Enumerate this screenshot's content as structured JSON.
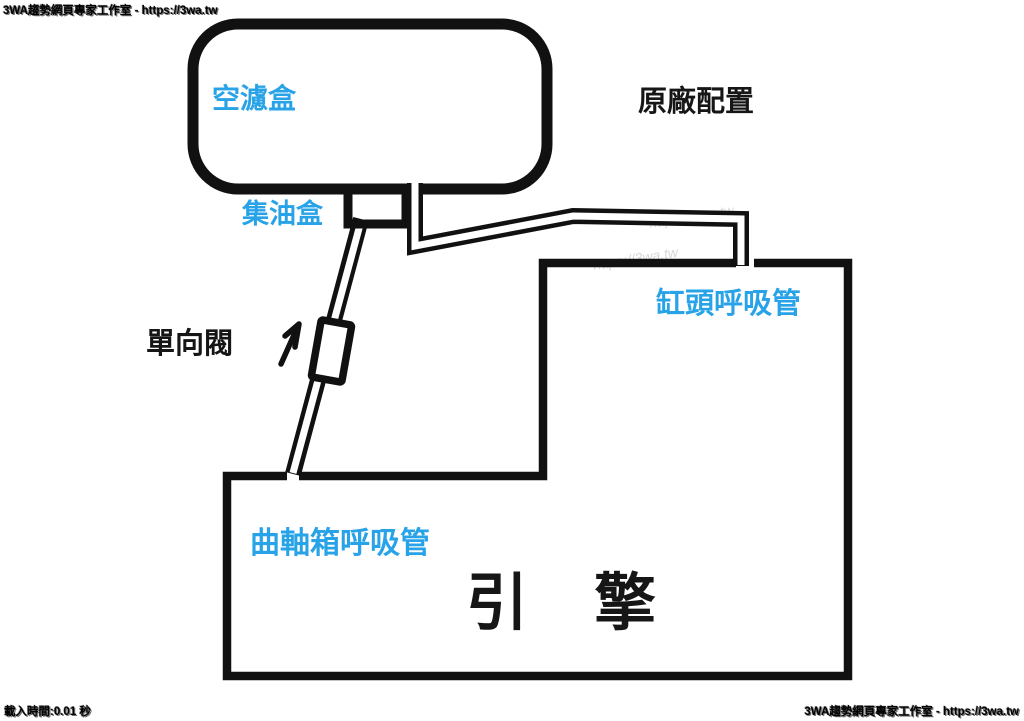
{
  "watermarks": {
    "top_left": "3WA趨勢網頁專家工作室 - https://3wa.tw",
    "bottom_left": "載入時間:0.01 秒",
    "bottom_right": "3WA趨勢網頁專家工作室 - https://3wa.tw",
    "faint_tile": "https://3wa.tw"
  },
  "diagram": {
    "title": "原廠配置",
    "labels": {
      "air_filter_box": "空濾盒",
      "oil_collector": "集油盒",
      "one_way_valve": "單向閥",
      "cylinder_head_breather": "缸頭呼吸管",
      "crankcase_breather": "曲軸箱呼吸管",
      "engine": "引　擎"
    },
    "colors": {
      "label_blue": "#29A3E8",
      "line_black": "#111111",
      "background": "#FFFFFF"
    }
  }
}
